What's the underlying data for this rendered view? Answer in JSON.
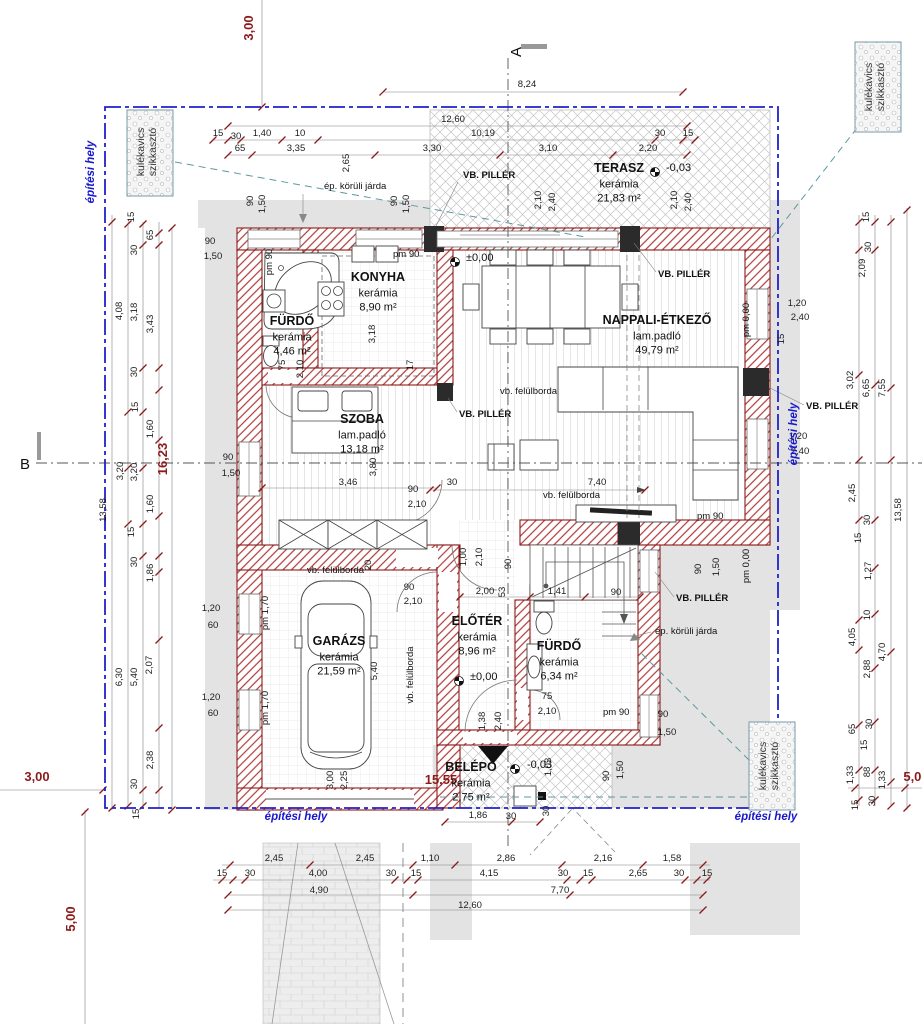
{
  "section_markers": {
    "a": "A",
    "b": "B"
  },
  "colors": {
    "wall": "#8b1a1a",
    "boundary_blue": "#2020cc",
    "red_dim": "#8b1a1a",
    "teal": "#5b9aa0",
    "site_label_blue": "#1818cc",
    "concrete_gray": "#e3e3e3"
  },
  "rooms": [
    {
      "name": "KONYHA",
      "finish": "kerámia",
      "area": "8,90 m²",
      "x": 378,
      "y": 281
    },
    {
      "name": "FÜRDŐ",
      "finish": "kerámia",
      "area": "4,46 m²",
      "x": 292,
      "y": 325
    },
    {
      "name": "TERASZ",
      "finish": "kerámia",
      "area": "21,83 m²",
      "x": 619,
      "y": 172
    },
    {
      "name": "NAPPALI-ÉTKEZŐ",
      "finish": "lam.padló",
      "area": "49,79 m²",
      "x": 657,
      "y": 324
    },
    {
      "name": "SZOBA",
      "finish": "lam.padló",
      "area": "13,18 m²",
      "x": 362,
      "y": 423
    },
    {
      "name": "GARÁZS",
      "finish": "kerámia",
      "area": "21,59 m²",
      "x": 339,
      "y": 645
    },
    {
      "name": "ELŐTÉR",
      "finish": "kerámia",
      "area": "8,96 m²",
      "x": 477,
      "y": 625
    },
    {
      "name": "FÜRDŐ",
      "finish": "kerámia",
      "area": "6,34 m²",
      "x": 559,
      "y": 650
    },
    {
      "name": "BELÉPŐ",
      "finish": "kerámia",
      "area": "2,75 m²",
      "x": 471,
      "y": 771
    }
  ],
  "levels": [
    {
      "t": "±0,00",
      "x": 466,
      "y": 261,
      "mx": 455,
      "my": 262
    },
    {
      "t": "±0,00",
      "x": 470,
      "y": 680,
      "mx": 459,
      "my": 681
    },
    {
      "t": "-0,03",
      "x": 666,
      "y": 171,
      "mx": 655,
      "my": 172
    },
    {
      "t": "-0,03",
      "x": 527,
      "y": 768,
      "mx": 515,
      "my": 769
    }
  ],
  "callouts": [
    {
      "t": "VB. PILLÉR",
      "x": 463,
      "y": 178,
      "b": 1
    },
    {
      "t": "VB. PILLÉR",
      "x": 658,
      "y": 277,
      "b": 1
    },
    {
      "t": "VB. PILLÉR",
      "x": 459,
      "y": 417,
      "b": 1
    },
    {
      "t": "VB. PILLÉR",
      "x": 806,
      "y": 409,
      "b": 1
    },
    {
      "t": "VB. PILLÉR",
      "x": 676,
      "y": 601,
      "b": 1
    },
    {
      "t": "vb. felülborda",
      "x": 307,
      "y": 573
    },
    {
      "t": "vb. felülborda",
      "x": 543,
      "y": 498
    },
    {
      "t": "vb. felülborda",
      "x": 413,
      "y": 675,
      "r": -90
    },
    {
      "t": "vb. felülborda",
      "x": 500,
      "y": 394
    },
    {
      "t": "ép. körüli járda",
      "x": 324,
      "y": 189
    },
    {
      "t": "ép. körüli járda",
      "x": 655,
      "y": 634
    },
    {
      "t": "pm 90",
      "x": 393,
      "y": 257
    },
    {
      "t": "pm 90",
      "x": 697,
      "y": 519
    },
    {
      "t": "pm 90",
      "x": 603,
      "y": 715
    },
    {
      "t": "pm 90",
      "x": 272,
      "y": 262,
      "r": -90
    },
    {
      "t": "pm 0,00",
      "x": 749,
      "y": 320,
      "r": -90
    },
    {
      "t": "pm 0,00",
      "x": 749,
      "y": 566,
      "r": -90
    },
    {
      "t": "pm 1,70",
      "x": 268,
      "y": 613,
      "r": -90
    },
    {
      "t": "pm 1,70",
      "x": 268,
      "y": 708,
      "r": -90
    }
  ],
  "site": {
    "boundary_label": "építési hely",
    "boundary_labels": [
      {
        "x": 94,
        "y": 172,
        "r": -90
      },
      {
        "x": 797,
        "y": 434,
        "r": -90
      },
      {
        "x": 296,
        "y": 820
      },
      {
        "x": 766,
        "y": 820
      }
    ],
    "szikkaszto_label": [
      "kulékavics",
      "szikkasztó"
    ],
    "szikkaszto": [
      {
        "x": 150,
        "y": 152
      },
      {
        "x": 878,
        "y": 87
      },
      {
        "x": 772,
        "y": 766
      }
    ]
  },
  "red_dims": [
    {
      "t": "3,00",
      "x": 253,
      "y": 28,
      "r": -90
    },
    {
      "t": "3,00",
      "x": 37,
      "y": 781
    },
    {
      "t": "16,23",
      "x": 167,
      "y": 459,
      "r": -90
    },
    {
      "t": "15,55",
      "x": 441,
      "y": 784
    },
    {
      "t": "5,00",
      "x": 75,
      "y": 919,
      "r": -90
    },
    {
      "t": "5,00",
      "x": 916,
      "y": 781
    }
  ],
  "dims": [
    {
      "t": "8,24",
      "x": 527,
      "y": 87
    },
    {
      "t": "12,60",
      "x": 453,
      "y": 122
    },
    {
      "t": "15",
      "x": 218,
      "y": 136
    },
    {
      "t": "30",
      "x": 236,
      "y": 139
    },
    {
      "t": "1,40",
      "x": 262,
      "y": 136
    },
    {
      "t": "10",
      "x": 300,
      "y": 136
    },
    {
      "t": "10,19",
      "x": 483,
      "y": 136
    },
    {
      "t": "30",
      "x": 660,
      "y": 136
    },
    {
      "t": "15",
      "x": 688,
      "y": 136
    },
    {
      "t": "65",
      "x": 240,
      "y": 151
    },
    {
      "t": "3,35",
      "x": 296,
      "y": 151
    },
    {
      "t": "3,30",
      "x": 432,
      "y": 151
    },
    {
      "t": "3,10",
      "x": 548,
      "y": 151
    },
    {
      "t": "2,20",
      "x": 648,
      "y": 151
    },
    {
      "t": "2,65",
      "x": 349,
      "y": 163,
      "r": -90
    },
    {
      "t": "90",
      "x": 253,
      "y": 201,
      "r": -90
    },
    {
      "t": "1,50",
      "x": 265,
      "y": 204,
      "r": -90
    },
    {
      "t": "90",
      "x": 397,
      "y": 201,
      "r": -90
    },
    {
      "t": "1,50",
      "x": 409,
      "y": 204,
      "r": -90
    },
    {
      "t": "2,10",
      "x": 541,
      "y": 200,
      "r": -90
    },
    {
      "t": "2,40",
      "x": 555,
      "y": 202,
      "r": -90
    },
    {
      "t": "2,10",
      "x": 677,
      "y": 200,
      "r": -90
    },
    {
      "t": "2,40",
      "x": 691,
      "y": 202,
      "r": -90
    },
    {
      "t": "90",
      "x": 210,
      "y": 244
    },
    {
      "t": "1,50",
      "x": 213,
      "y": 259
    },
    {
      "t": "15",
      "x": 134,
      "y": 217,
      "r": -90
    },
    {
      "t": "30",
      "x": 137,
      "y": 250,
      "r": -90
    },
    {
      "t": "65",
      "x": 153,
      "y": 235,
      "r": -90
    },
    {
      "t": "4,08",
      "x": 122,
      "y": 311,
      "r": -90
    },
    {
      "t": "3,18",
      "x": 137,
      "y": 312,
      "r": -90
    },
    {
      "t": "3,43",
      "x": 153,
      "y": 324,
      "r": -90
    },
    {
      "t": "30",
      "x": 137,
      "y": 372,
      "r": -90
    },
    {
      "t": "15",
      "x": 138,
      "y": 407,
      "r": -90
    },
    {
      "t": "1,60",
      "x": 153,
      "y": 429,
      "r": -90
    },
    {
      "t": "3,20",
      "x": 123,
      "y": 471,
      "r": -90
    },
    {
      "t": "3,20",
      "x": 137,
      "y": 472,
      "r": -90
    },
    {
      "t": "1,60",
      "x": 153,
      "y": 504,
      "r": -90
    },
    {
      "t": "13,58",
      "x": 106,
      "y": 510,
      "r": -90
    },
    {
      "t": "15",
      "x": 134,
      "y": 532,
      "r": -90
    },
    {
      "t": "30",
      "x": 137,
      "y": 562,
      "r": -90
    },
    {
      "t": "1,86",
      "x": 153,
      "y": 573,
      "r": -90
    },
    {
      "t": "6,30",
      "x": 122,
      "y": 677,
      "r": -90
    },
    {
      "t": "5,40",
      "x": 137,
      "y": 677,
      "r": -90
    },
    {
      "t": "2,07",
      "x": 152,
      "y": 665,
      "r": -90
    },
    {
      "t": "2,38",
      "x": 153,
      "y": 760,
      "r": -90
    },
    {
      "t": "30",
      "x": 137,
      "y": 784,
      "r": -90
    },
    {
      "t": "15",
      "x": 139,
      "y": 814,
      "r": -90
    },
    {
      "t": "1,20",
      "x": 211,
      "y": 611
    },
    {
      "t": "60",
      "x": 213,
      "y": 628
    },
    {
      "t": "1,20",
      "x": 211,
      "y": 700
    },
    {
      "t": "60",
      "x": 213,
      "y": 716
    },
    {
      "t": "90",
      "x": 228,
      "y": 460
    },
    {
      "t": "1,50",
      "x": 231,
      "y": 476
    },
    {
      "t": "15",
      "x": 869,
      "y": 217,
      "r": -90
    },
    {
      "t": "30",
      "x": 871,
      "y": 247,
      "r": -90
    },
    {
      "t": "2,09",
      "x": 865,
      "y": 268,
      "r": -90
    },
    {
      "t": "3,02",
      "x": 853,
      "y": 380,
      "r": -90
    },
    {
      "t": "6,65",
      "x": 869,
      "y": 388,
      "r": -90
    },
    {
      "t": "7,55",
      "x": 885,
      "y": 388,
      "r": -90
    },
    {
      "t": "2,45",
      "x": 855,
      "y": 493,
      "r": -90
    },
    {
      "t": "30",
      "x": 870,
      "y": 520,
      "r": -90
    },
    {
      "t": "15",
      "x": 861,
      "y": 538,
      "r": -90
    },
    {
      "t": "1,27",
      "x": 871,
      "y": 571,
      "r": -90
    },
    {
      "t": "13,58",
      "x": 901,
      "y": 510,
      "r": -90
    },
    {
      "t": "10",
      "x": 870,
      "y": 615,
      "r": -90
    },
    {
      "t": "4,05",
      "x": 855,
      "y": 637,
      "r": -90
    },
    {
      "t": "4,70",
      "x": 885,
      "y": 652,
      "r": -90
    },
    {
      "t": "2,88",
      "x": 870,
      "y": 669,
      "r": -90
    },
    {
      "t": "65",
      "x": 855,
      "y": 729,
      "r": -90
    },
    {
      "t": "30",
      "x": 872,
      "y": 724,
      "r": -90
    },
    {
      "t": "15",
      "x": 867,
      "y": 745,
      "r": -90
    },
    {
      "t": "1,33",
      "x": 853,
      "y": 775,
      "r": -90
    },
    {
      "t": "88",
      "x": 870,
      "y": 772,
      "r": -90
    },
    {
      "t": "1,33",
      "x": 885,
      "y": 780,
      "r": -90
    },
    {
      "t": "15",
      "x": 858,
      "y": 805,
      "r": -90
    },
    {
      "t": "30",
      "x": 875,
      "y": 801,
      "r": -90
    },
    {
      "t": "1,20",
      "x": 797,
      "y": 306
    },
    {
      "t": "2,40",
      "x": 800,
      "y": 320
    },
    {
      "t": "1,20",
      "x": 798,
      "y": 439
    },
    {
      "t": "2,40",
      "x": 800,
      "y": 454
    },
    {
      "t": "15",
      "x": 784,
      "y": 339,
      "r": -90
    },
    {
      "t": "90",
      "x": 701,
      "y": 569,
      "r": -90
    },
    {
      "t": "1,50",
      "x": 719,
      "y": 567,
      "r": -90
    },
    {
      "t": "2,45",
      "x": 274,
      "y": 861
    },
    {
      "t": "2,45",
      "x": 365,
      "y": 861
    },
    {
      "t": "1,10",
      "x": 430,
      "y": 861
    },
    {
      "t": "2,86",
      "x": 506,
      "y": 861
    },
    {
      "t": "2,16",
      "x": 603,
      "y": 861
    },
    {
      "t": "1,58",
      "x": 672,
      "y": 861
    },
    {
      "t": "15",
      "x": 222,
      "y": 876
    },
    {
      "t": "30",
      "x": 250,
      "y": 876
    },
    {
      "t": "4,00",
      "x": 318,
      "y": 876
    },
    {
      "t": "30",
      "x": 391,
      "y": 876
    },
    {
      "t": "15",
      "x": 416,
      "y": 876
    },
    {
      "t": "4,15",
      "x": 489,
      "y": 876
    },
    {
      "t": "30",
      "x": 563,
      "y": 876
    },
    {
      "t": "15",
      "x": 588,
      "y": 876
    },
    {
      "t": "2,65",
      "x": 638,
      "y": 876
    },
    {
      "t": "30",
      "x": 679,
      "y": 876
    },
    {
      "t": "15",
      "x": 707,
      "y": 876
    },
    {
      "t": "4,90",
      "x": 319,
      "y": 893
    },
    {
      "t": "7,70",
      "x": 560,
      "y": 893
    },
    {
      "t": "12,60",
      "x": 470,
      "y": 908
    },
    {
      "t": "3,18",
      "x": 375,
      "y": 334,
      "r": -90
    },
    {
      "t": "17",
      "x": 413,
      "y": 365,
      "r": -90
    },
    {
      "t": "3,46",
      "x": 348,
      "y": 485
    },
    {
      "t": "3,80",
      "x": 376,
      "y": 467,
      "r": -90
    },
    {
      "t": "90",
      "x": 413,
      "y": 492
    },
    {
      "t": "2,10",
      "x": 417,
      "y": 507
    },
    {
      "t": "30",
      "x": 452,
      "y": 485
    },
    {
      "t": "20",
      "x": 371,
      "y": 565,
      "r": -90
    },
    {
      "t": "7,40",
      "x": 597,
      "y": 485
    },
    {
      "t": "1,00",
      "x": 466,
      "y": 557,
      "r": -90
    },
    {
      "t": "2,10",
      "x": 482,
      "y": 557,
      "r": -90
    },
    {
      "t": "90",
      "x": 511,
      "y": 564,
      "r": -90
    },
    {
      "t": "2,00",
      "x": 485,
      "y": 594
    },
    {
      "t": "53",
      "x": 505,
      "y": 592,
      "r": -90
    },
    {
      "t": "1,41",
      "x": 557,
      "y": 594
    },
    {
      "t": "90",
      "x": 616,
      "y": 595
    },
    {
      "t": "90",
      "x": 409,
      "y": 590
    },
    {
      "t": "2,10",
      "x": 413,
      "y": 604
    },
    {
      "t": "5,40",
      "x": 377,
      "y": 671,
      "r": -90
    },
    {
      "t": "3,00",
      "x": 333,
      "y": 780,
      "r": -90
    },
    {
      "t": "2,25",
      "x": 347,
      "y": 780,
      "r": -90
    },
    {
      "t": "75",
      "x": 285,
      "y": 365,
      "r": -90
    },
    {
      "t": "2,10",
      "x": 303,
      "y": 369,
      "r": -90
    },
    {
      "t": "75",
      "x": 547,
      "y": 699
    },
    {
      "t": "2,10",
      "x": 547,
      "y": 714
    },
    {
      "t": "1,38",
      "x": 485,
      "y": 721,
      "r": -90
    },
    {
      "t": "2,40",
      "x": 501,
      "y": 721,
      "r": -90
    },
    {
      "t": "1,03",
      "x": 551,
      "y": 767,
      "r": -90
    },
    {
      "t": "30",
      "x": 549,
      "y": 811,
      "r": -90
    },
    {
      "t": "1,86",
      "x": 478,
      "y": 818
    },
    {
      "t": "30",
      "x": 511,
      "y": 819
    },
    {
      "t": "90",
      "x": 663,
      "y": 717
    },
    {
      "t": "1,50",
      "x": 667,
      "y": 735
    },
    {
      "t": "90",
      "x": 609,
      "y": 776,
      "r": -90
    },
    {
      "t": "1,50",
      "x": 623,
      "y": 770,
      "r": -90
    }
  ]
}
